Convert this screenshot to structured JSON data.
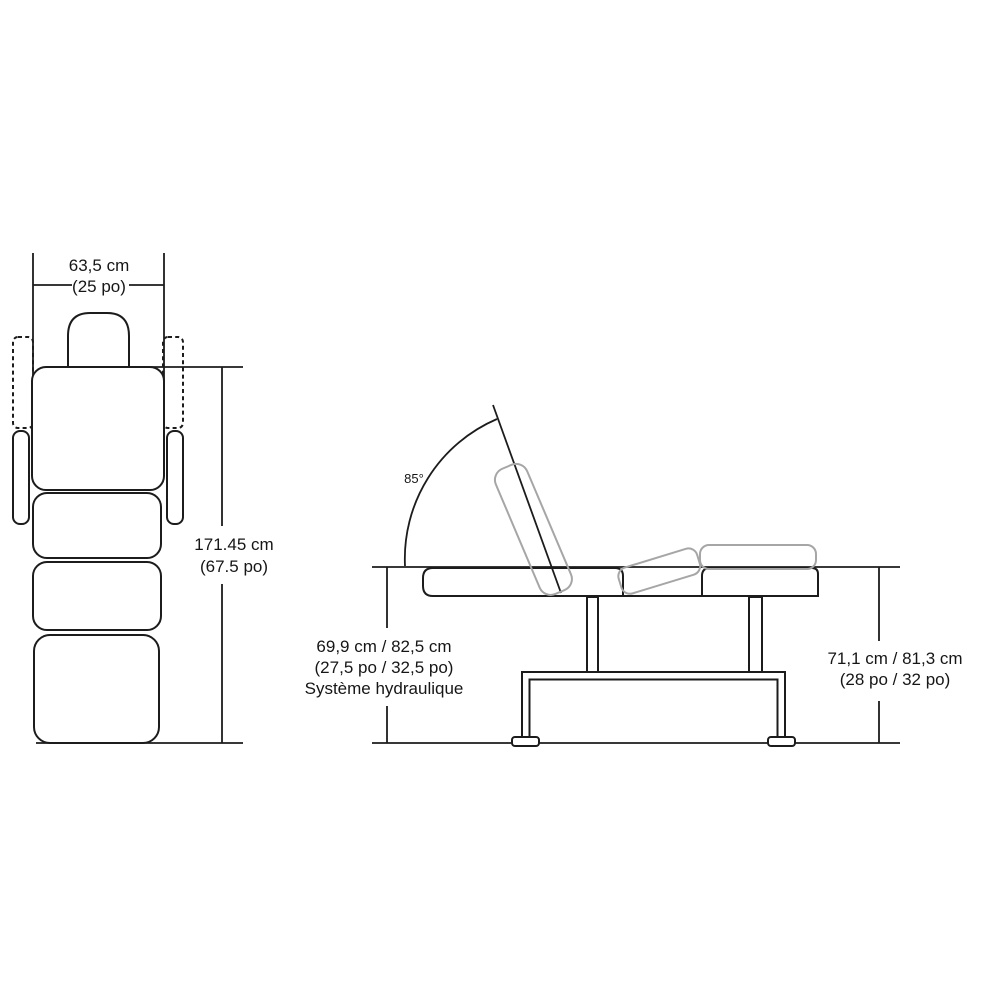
{
  "figure": {
    "front_view": {
      "width_label_line1": "63,5 cm",
      "width_label_line2": "(25 po)",
      "height_label_line1": "171.45 cm",
      "height_label_line2": "(67.5 po)"
    },
    "side_view": {
      "angle_label": "85°",
      "hydraulic_label_line1": "69,9 cm / 82,5 cm",
      "hydraulic_label_line2": "(27,5 po / 32,5 po)",
      "hydraulic_label_line3": "Système hydraulique",
      "height_label_line1": "71,1 cm / 81,3 cm",
      "height_label_line2": "(28 po / 32 po)"
    },
    "colors": {
      "line": "#1c1c1c",
      "ghost_line": "#a6a6a6",
      "background": "#ffffff"
    }
  }
}
